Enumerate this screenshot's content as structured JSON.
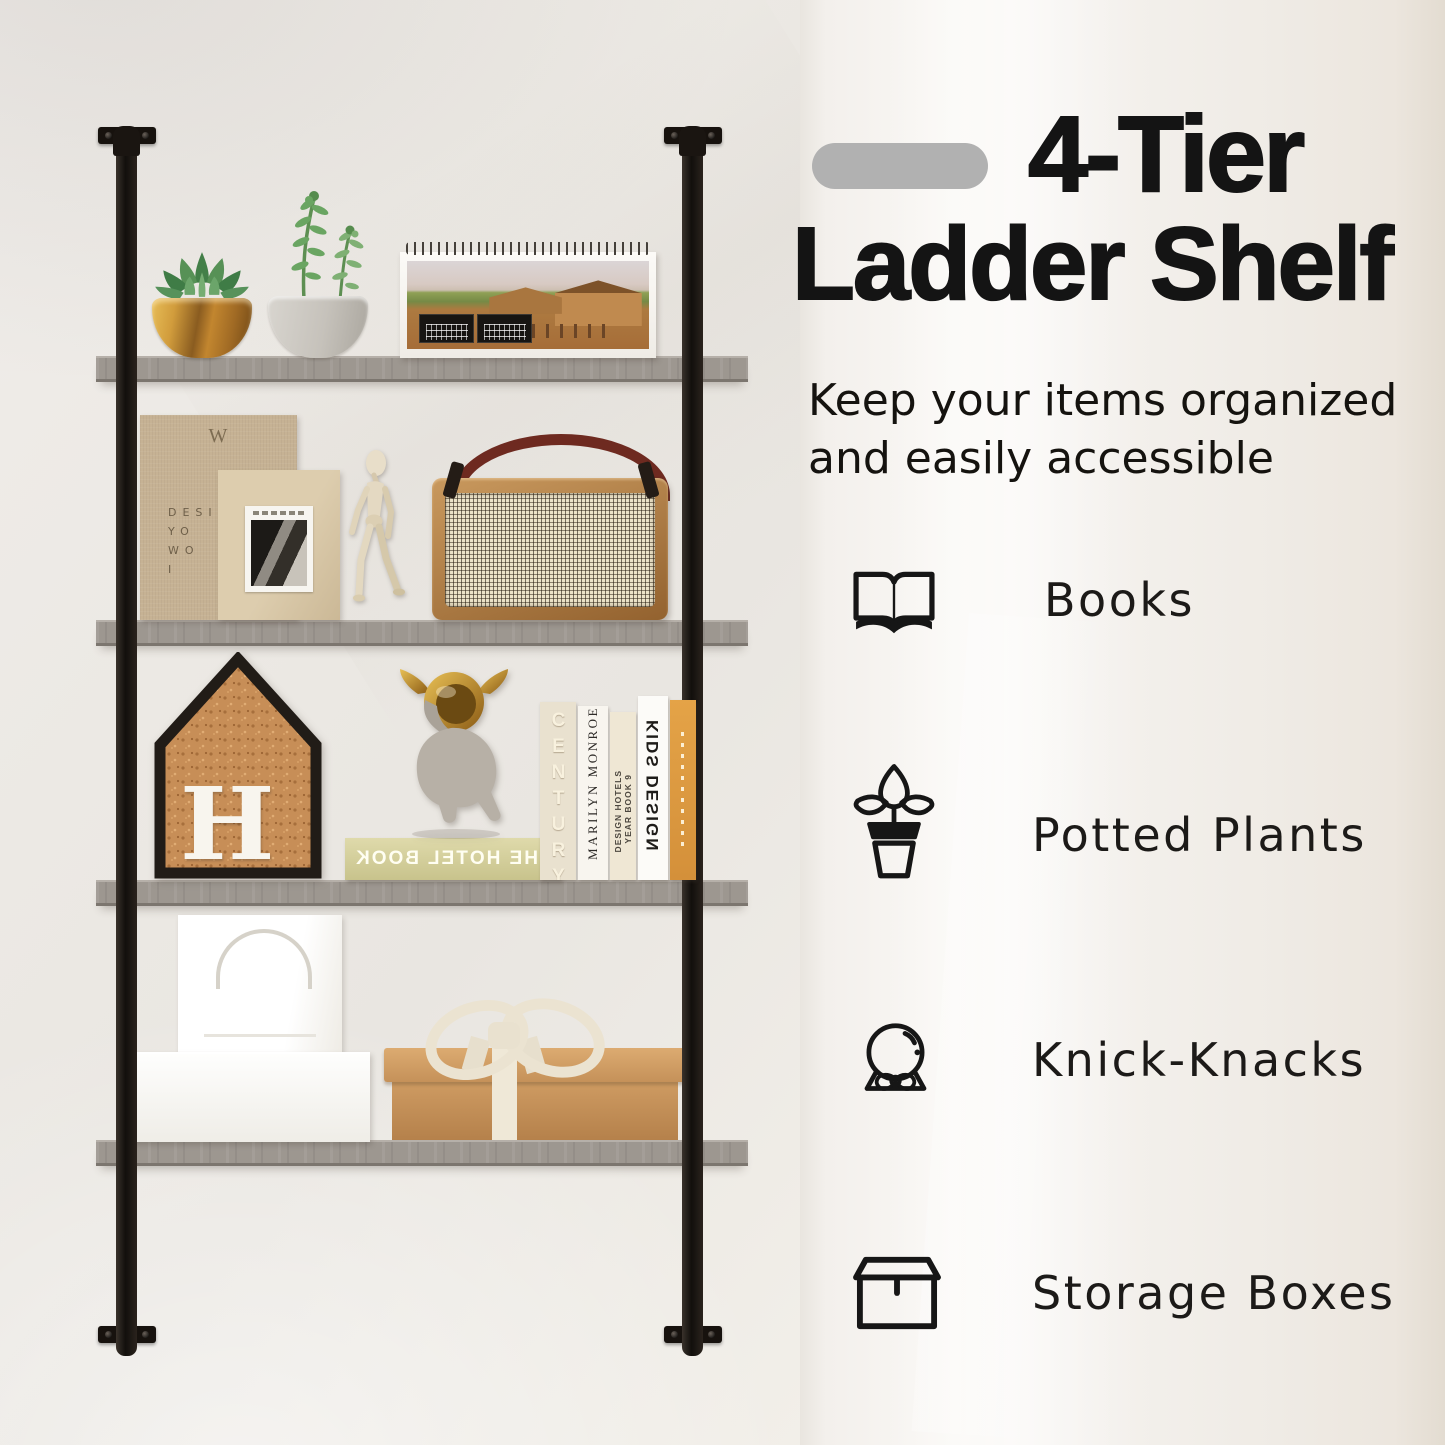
{
  "colors": {
    "badge": "#b1b1b1",
    "heading_text": "#141414",
    "shelf_board": "#9d9790",
    "shelf_frame": "#17130f"
  },
  "heading": {
    "line1": "4-Tier",
    "line2": "Ladder Shelf"
  },
  "subtitle": {
    "line1": "Keep your items organized",
    "line2": "and easily accessible"
  },
  "features": [
    {
      "icon": "open-book-icon",
      "label": "Books"
    },
    {
      "icon": "potted-plant-icon",
      "label": "Potted Plants"
    },
    {
      "icon": "snow-globe-icon",
      "label": "Knick-Knacks"
    },
    {
      "icon": "storage-box-icon",
      "label": "Storage Boxes"
    }
  ],
  "photo_texts": {
    "linen_book_mark": "W",
    "linen_book_line1": "DESIG",
    "linen_book_line2": "YO",
    "linen_book_line3": "WO",
    "linen_book_line4": "I",
    "cork_letter": "H",
    "hotel_book_title": "THE HOTEL BOOK",
    "spine_century": "CENTURY",
    "spine_marilyn": "MARILYN MONROE",
    "spine_design_hotels_line1": "DESIGN HOTELS",
    "spine_design_hotels_line2": "YEAR BOOK 9",
    "spine_kids_design": "KIDS DESIGN"
  }
}
